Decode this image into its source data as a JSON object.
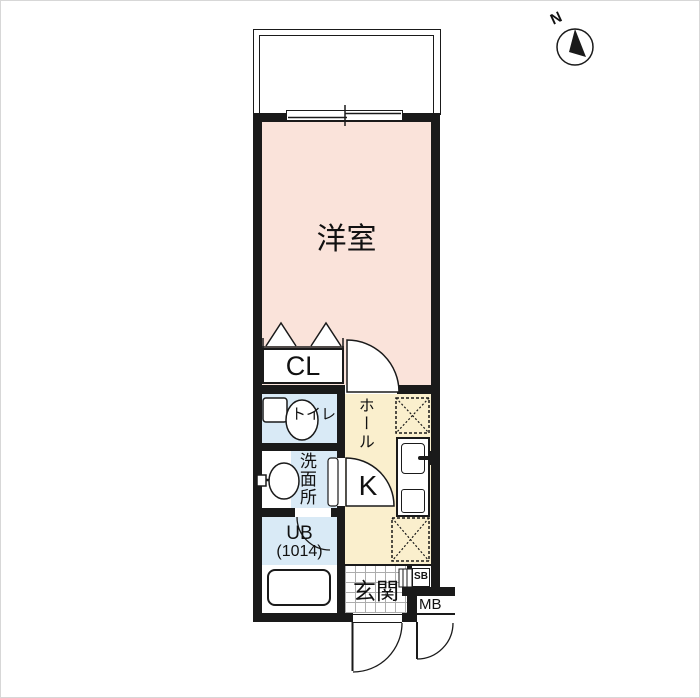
{
  "compass": {
    "label": "N"
  },
  "colors": {
    "wall": "#1a1a1a",
    "room_pink": "#fae3da",
    "hall_yellow": "#faefcd",
    "wet_area_blue": "#d9eaf6"
  },
  "rooms": {
    "western_room": {
      "label": "洋室"
    },
    "closet": {
      "label": "CL"
    },
    "toilet": {
      "label": "トイレ"
    },
    "washroom": {
      "label": "洗面所"
    },
    "bath": {
      "label": "UB",
      "size": "(1014)"
    },
    "hall": {
      "label": "ホール"
    },
    "kitchen": {
      "label": "K"
    },
    "entrance": {
      "label": "玄関"
    },
    "shoe_box": {
      "label": "SB"
    },
    "meter_box": {
      "label": "MB"
    }
  }
}
